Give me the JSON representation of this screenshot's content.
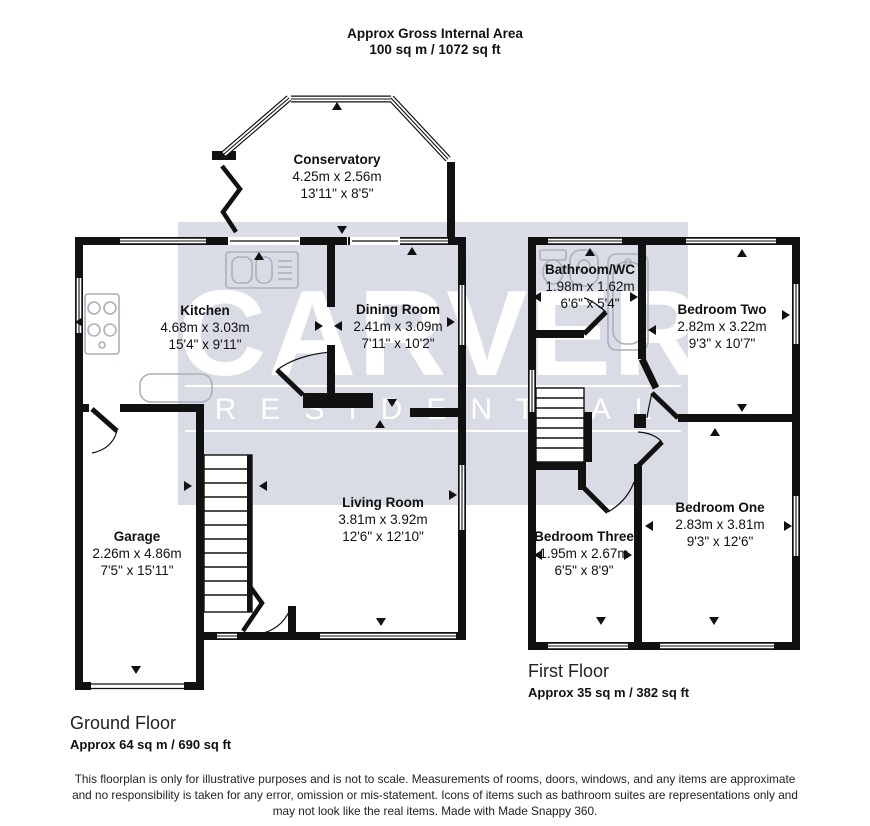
{
  "header": {
    "line1": "Approx Gross Internal Area",
    "line2": "100 sq m / 1072 sq ft"
  },
  "watermark": {
    "line1": "CARVER",
    "line2": "RESIDENTIAL"
  },
  "rooms": {
    "conservatory": {
      "name": "Conservatory",
      "metric": "4.25m x 2.56m",
      "imperial": "13'11\" x 8'5\""
    },
    "kitchen": {
      "name": "Kitchen",
      "metric": "4.68m x 3.03m",
      "imperial": "15'4\" x 9'11\""
    },
    "dining": {
      "name": "Dining Room",
      "metric": "2.41m x 3.09m",
      "imperial": "7'11\" x 10'2\""
    },
    "living": {
      "name": "Living Room",
      "metric": "3.81m x 3.92m",
      "imperial": "12'6\" x 12'10\""
    },
    "garage": {
      "name": "Garage",
      "metric": "2.26m x 4.86m",
      "imperial": "7'5\" x 15'11\""
    },
    "bathroom": {
      "name": "Bathroom/WC",
      "metric": "1.98m x 1.62m",
      "imperial": "6'6\" x 5'4\""
    },
    "bedroom2": {
      "name": "Bedroom Two",
      "metric": "2.82m x 3.22m",
      "imperial": "9'3\" x 10'7\""
    },
    "bedroom1": {
      "name": "Bedroom One",
      "metric": "2.83m x 3.81m",
      "imperial": "9'3\" x 12'6\""
    },
    "bedroom3": {
      "name": "Bedroom Three",
      "metric": "1.95m x 2.67m",
      "imperial": "6'5\" x 8'9\""
    }
  },
  "floors": {
    "ground": {
      "title": "Ground Floor",
      "area": "Approx 64 sq m / 690 sq ft"
    },
    "first": {
      "title": "First Floor",
      "area": "Approx 35 sq m / 382 sq ft"
    }
  },
  "disclaimer": {
    "line1": "This floorplan is only for illustrative purposes and is not to scale. Measurements of rooms, doors, windows, and any items are approximate",
    "line2": "and no responsibility is taken for any error, omission or mis-statement. Icons of items such as bathroom suites are representations only and",
    "line3": "may not look like the real items. Made with Made Snappy 360."
  },
  "colors": {
    "wall": "#111111",
    "watermark_bg": "#d8dbe4",
    "watermark_text": "#ffffff",
    "fixture": "#aab0bb"
  }
}
